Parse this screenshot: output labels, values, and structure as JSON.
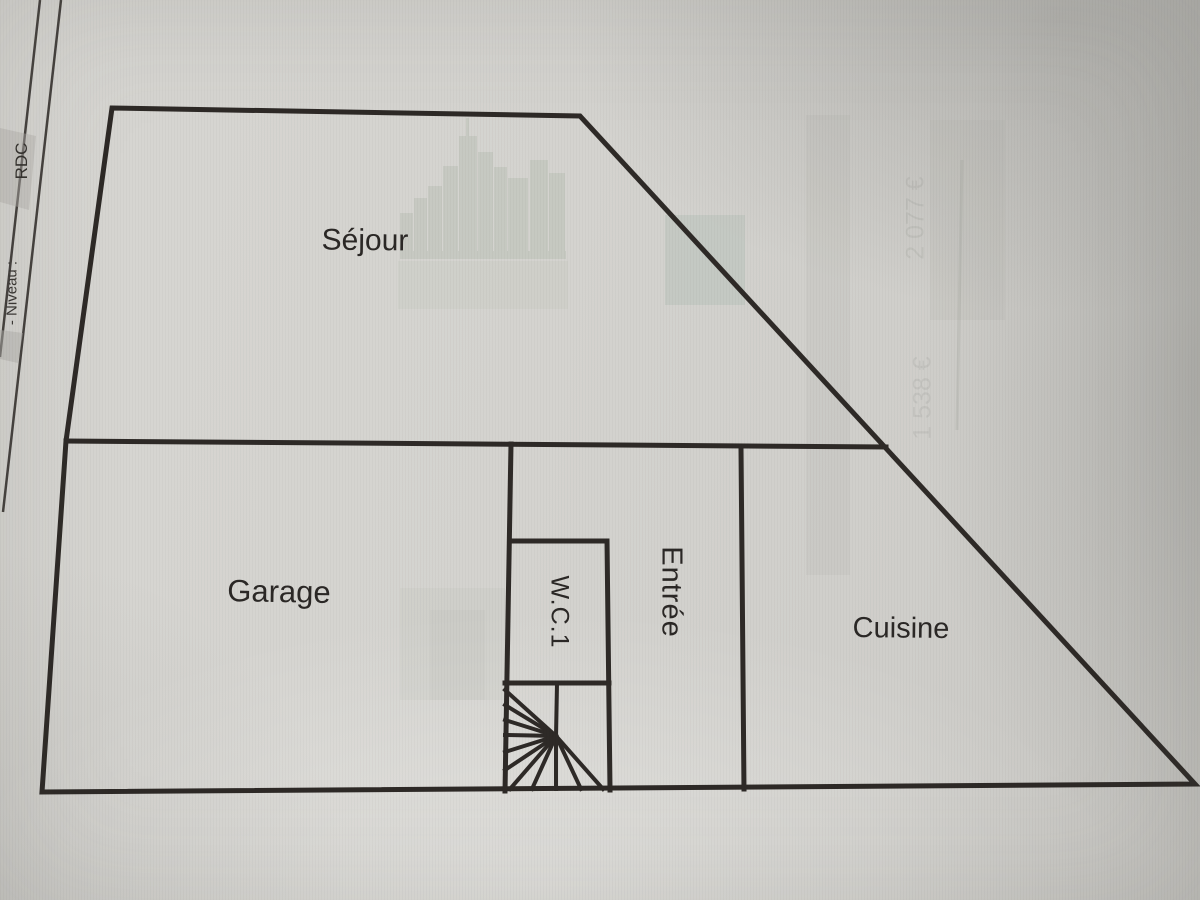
{
  "sheet": {
    "level_label": "- Niveau :",
    "level_value": "RDC"
  },
  "rooms": {
    "living": "Séjour",
    "garage": "Garage",
    "wc": "W.C.1",
    "entry": "Entrée",
    "kitchen": "Cuisine"
  },
  "bleed_through": {
    "price_top": "2 077 €",
    "price_bottom": "1 538 €"
  },
  "colors": {
    "paper": "#d3d2ce",
    "wall_line": "#2e2a27",
    "label_text": "#2b2826"
  }
}
